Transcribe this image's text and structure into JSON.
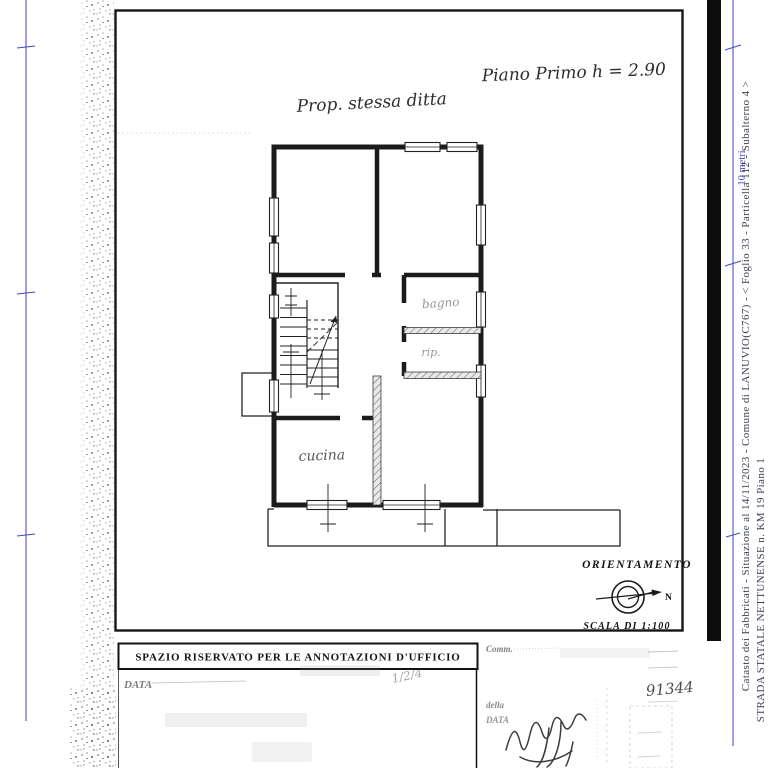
{
  "document": {
    "plan_notes": {
      "floor_note": "Piano Primo h = 2.90",
      "property_note": "Prop. stessa ditta"
    },
    "room_labels": {
      "bagno": "bagno",
      "rip": "rip.",
      "cucina": "cucina"
    },
    "orientation": {
      "title": "ORIENTAMENTO",
      "north": "N",
      "scale_label": "SCALA DI 1:100"
    },
    "scale_bar_label": "10 metri",
    "margin_captions": {
      "line1": "Catasto dei Fabbricati - Situazione al 14/11/2023 - Comune di LANUVIO(C767) - <  Foglio 33 - Particella  112 - Subalterno 4 >",
      "line2": "STRADA STATALE NETTUNENSE n. KM 19 Piano 1"
    },
    "office_annotations": {
      "header": "SPAZIO RISERVATO PER LE ANNOTAZIONI D'UFFICIO",
      "data_label": "DATA",
      "handwritten_fraction": "1/2/4",
      "comm_label": "Comm.",
      "della_label": "della",
      "right_data_label": "DATA",
      "protocol_number": "91344"
    },
    "colors": {
      "accent_blue": "#4545c4",
      "ink": "#1b1b1b"
    }
  }
}
